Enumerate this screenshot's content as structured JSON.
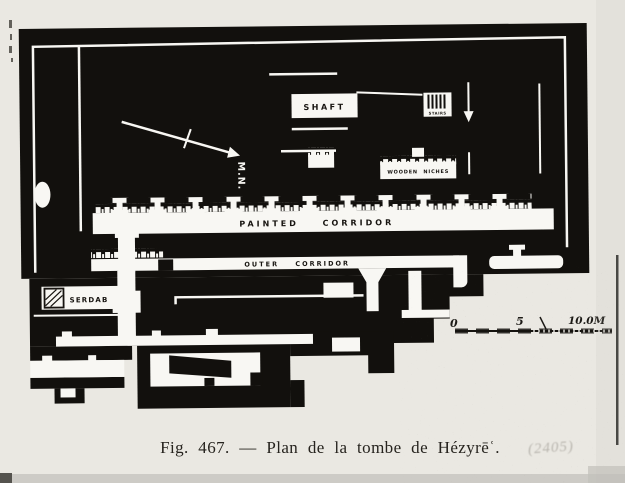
{
  "figure": {
    "caption": "Fig. 467. — Plan de la tombe de Hézyrēʿ.",
    "handwritten_note": "(2405)"
  },
  "plan": {
    "labels": {
      "shaft": "SHAFT",
      "stairs": "STAIRS",
      "magnetic_north": "M.N.",
      "wooden_niches": "WOODEN NICHES",
      "painted_corridor": "PAINTED CORRIDOR",
      "outer_corridor": "OUTER CORRIDOR",
      "serdab": "SERDAB"
    },
    "scale_bar": {
      "start": "0",
      "middle": "5",
      "end": "10.0M"
    }
  },
  "colors": {
    "ink": "#12100d",
    "paper": "#eae8e2",
    "plan_white": "#f8f7f3"
  }
}
